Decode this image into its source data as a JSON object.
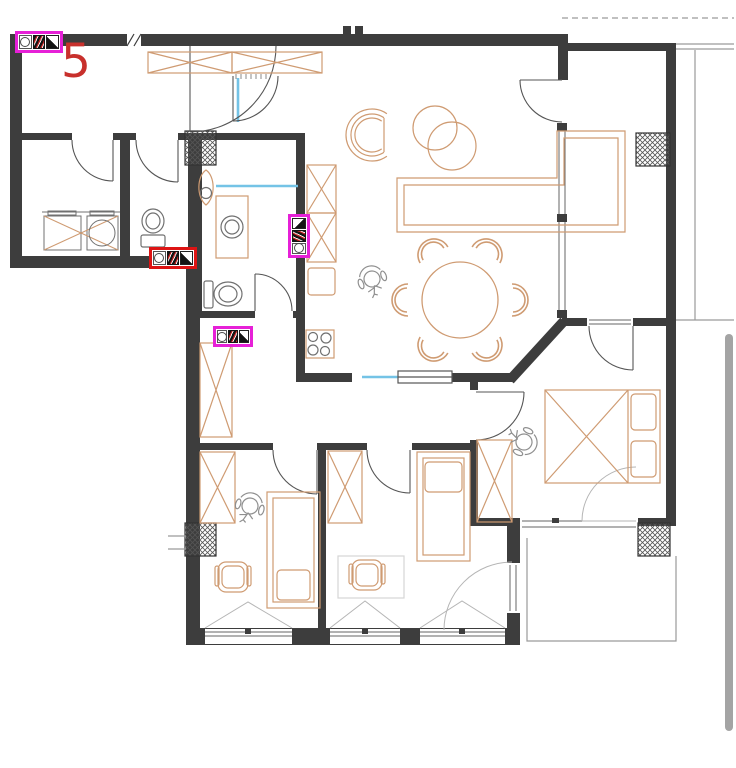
{
  "canvas": {
    "width": 736,
    "height": 768,
    "background": "#ffffff"
  },
  "drawing": {
    "type": "apartment-floor-plan",
    "unit_label": {
      "text": "5",
      "color": "#c8302c",
      "x": 61,
      "y": 38,
      "font_size": 47,
      "font_weight": 500
    },
    "palette": {
      "wall": "#3d3d3d",
      "furniture_outline": "#cf9b72",
      "fixture_outline": "#707070",
      "glass_blue": "#74c3e6",
      "light_line": "#9a9a9a",
      "annotation_magenta": "#e620d7",
      "annotation_red": "#dd1414"
    },
    "rooms": [
      "entry",
      "laundry",
      "wc",
      "bathroom",
      "kitchen",
      "living-dining",
      "corridor",
      "master-bedroom",
      "kids-room-1",
      "kids-room-2",
      "balcony-top",
      "balcony-bottom"
    ]
  },
  "annotations": {
    "markers": [
      {
        "id": "equipment-marker-entry",
        "outline_color": "#e620d7",
        "x": 15,
        "y": 31,
        "width": 48,
        "height": 22,
        "orientation": "horizontal"
      },
      {
        "id": "equipment-marker-wc",
        "outline_color": "#dd1414",
        "x": 149,
        "y": 247,
        "width": 48,
        "height": 22,
        "orientation": "horizontal"
      },
      {
        "id": "equipment-marker-kitchen",
        "outline_color": "#e620d7",
        "x": 288,
        "y": 214,
        "width": 22,
        "height": 44,
        "orientation": "vertical"
      },
      {
        "id": "equipment-marker-hall",
        "outline_color": "#e620d7",
        "x": 213,
        "y": 326,
        "width": 40,
        "height": 21,
        "orientation": "horizontal"
      }
    ]
  },
  "scrollbar": {
    "thumb": {
      "x": 725,
      "y": 334,
      "width": 8,
      "height": 397,
      "color": "#a4a4a4",
      "radius": 4
    }
  }
}
